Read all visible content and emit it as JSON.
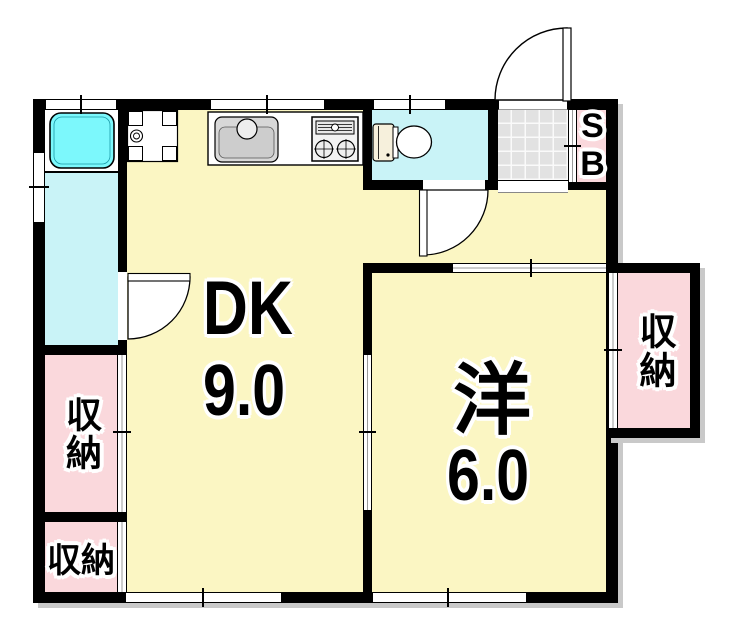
{
  "plan": {
    "type": "apartment-floor-plan",
    "rooms": {
      "dining_kitchen": {
        "label": "DK",
        "size": "9.0"
      },
      "western_room": {
        "label": "洋",
        "size": "6.0"
      },
      "storage_left_upper": {
        "label": "収納"
      },
      "storage_left_lower": {
        "label": "収納"
      },
      "storage_right": {
        "label": "収納"
      },
      "shoe_box": {
        "label": "SB"
      }
    },
    "colors": {
      "room_yellow": "#FBF6C3",
      "wet_area_cyan": "#C9F3F7",
      "bathtub_cyan": "#7CF8FC",
      "storage_pink": "#FAD8DC",
      "entry_tile_gray": "#E2E2E2",
      "wall_black": "#000000",
      "shadow_gray": "#C9C9C9",
      "fixture_gray": "#D8D8D8",
      "tank_cream": "#F6F0DC"
    }
  }
}
